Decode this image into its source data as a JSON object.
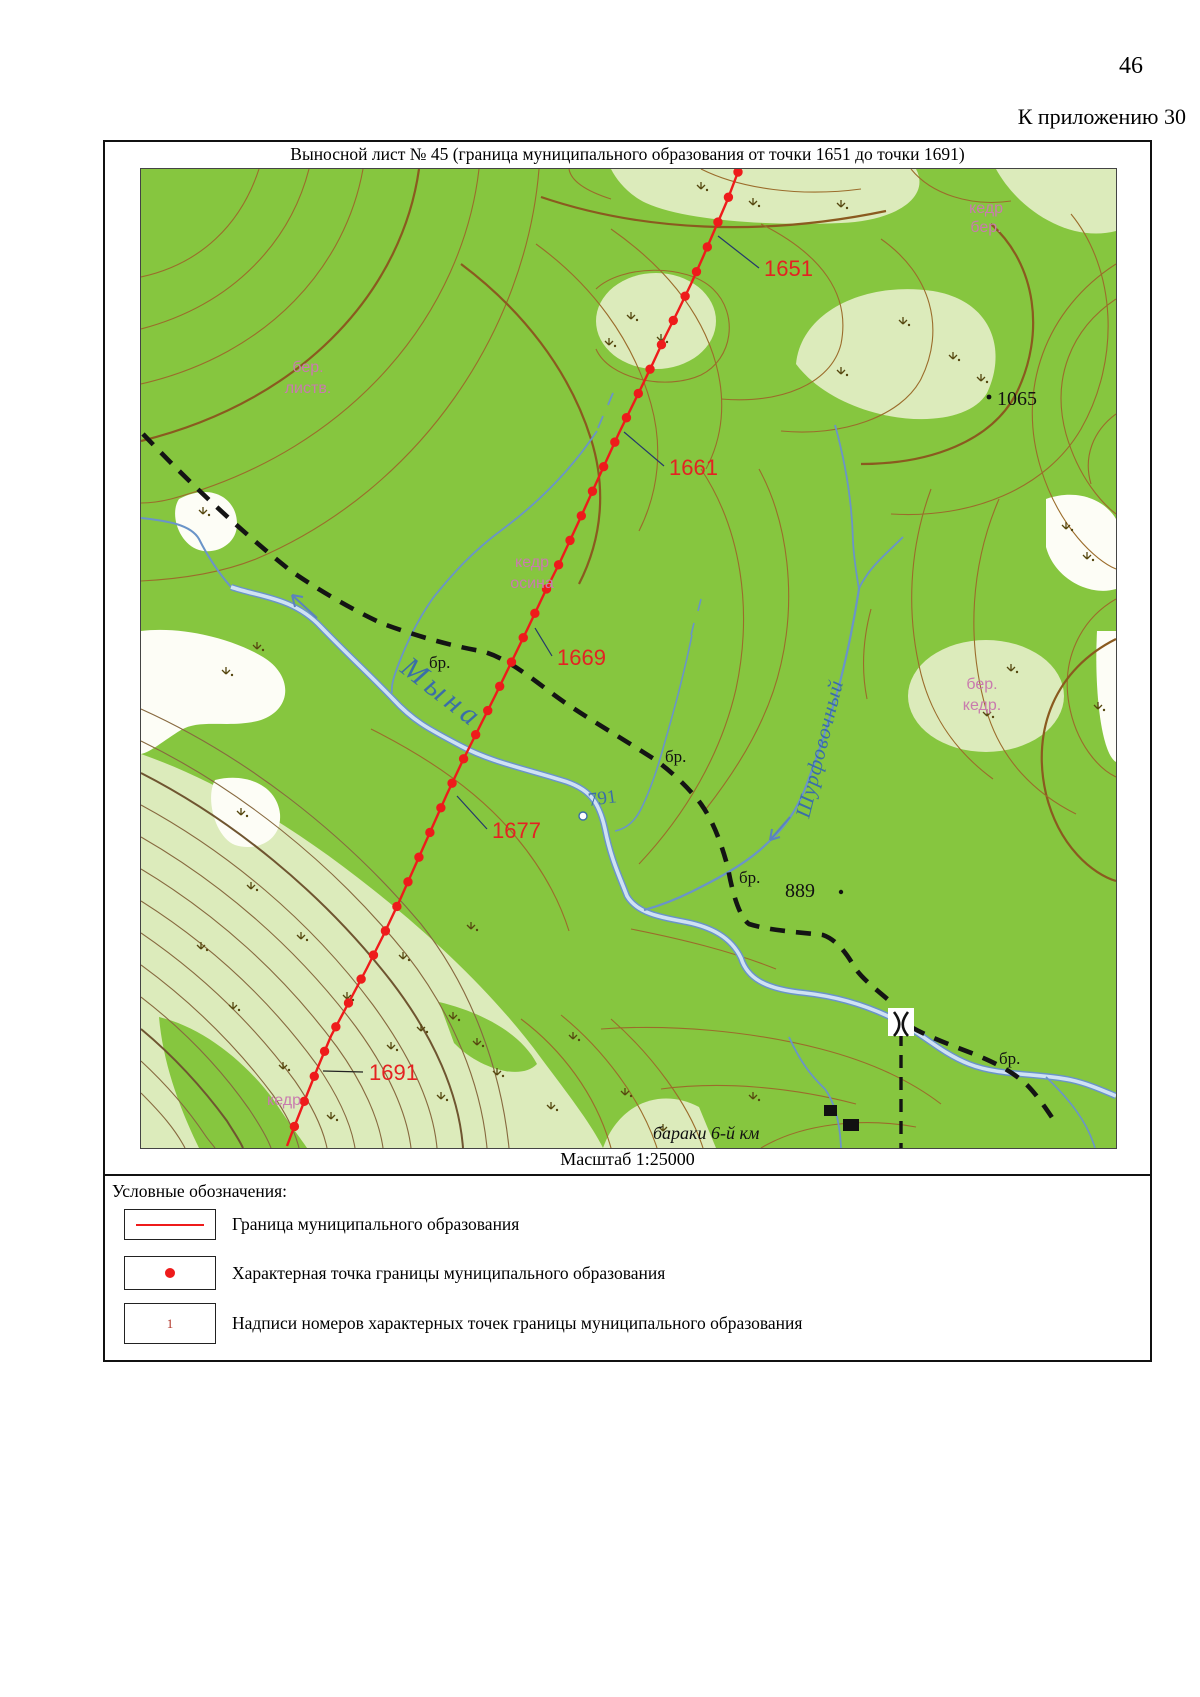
{
  "page": {
    "number": "46",
    "appendix_ref": "К приложению 30"
  },
  "sheet": {
    "title": "Выносной лист № 45 (граница муниципального образования от точки 1651 до точки 1691)",
    "scale": "Масштаб 1:25000"
  },
  "map": {
    "boundary_points": {
      "p1651": "1651",
      "p1661": "1661",
      "p1669": "1669",
      "p1677": "1677",
      "p1691": "1691"
    },
    "elevations": {
      "hill_ne": "1065",
      "hill_s": "889",
      "river_mark": "791"
    },
    "rivers": {
      "main": "Мына",
      "tributary": "Шурфовочный"
    },
    "ford_label": "бр.",
    "settlement_label": "бараки 6-й км",
    "vegetation": {
      "top_right_1": "кедр",
      "top_right_2": "бер.",
      "left_1": "бер.",
      "left_2": "листв.",
      "center_1": "кедр",
      "center_2": "осина",
      "right_1": "бер.",
      "right_2": "кедр.",
      "bottom_left": "кедр"
    }
  },
  "legend": {
    "heading": "Условные обозначения:",
    "items": [
      {
        "label": "Граница муниципального образования"
      },
      {
        "label": "Характерная точка границы муниципального образования"
      },
      {
        "symbol_text": "1",
        "label": "Надписи номеров характерных точек границы муниципального образования"
      }
    ]
  },
  "colors": {
    "forest": "#86c63f",
    "clearing": "#dcebbb",
    "contour": "#9b6c2b",
    "water": "#6a94c8",
    "water_text": "#3a6ea8",
    "boundary": "#ee1b1b",
    "veg_label": "#c97bae",
    "trail": "#141414"
  }
}
